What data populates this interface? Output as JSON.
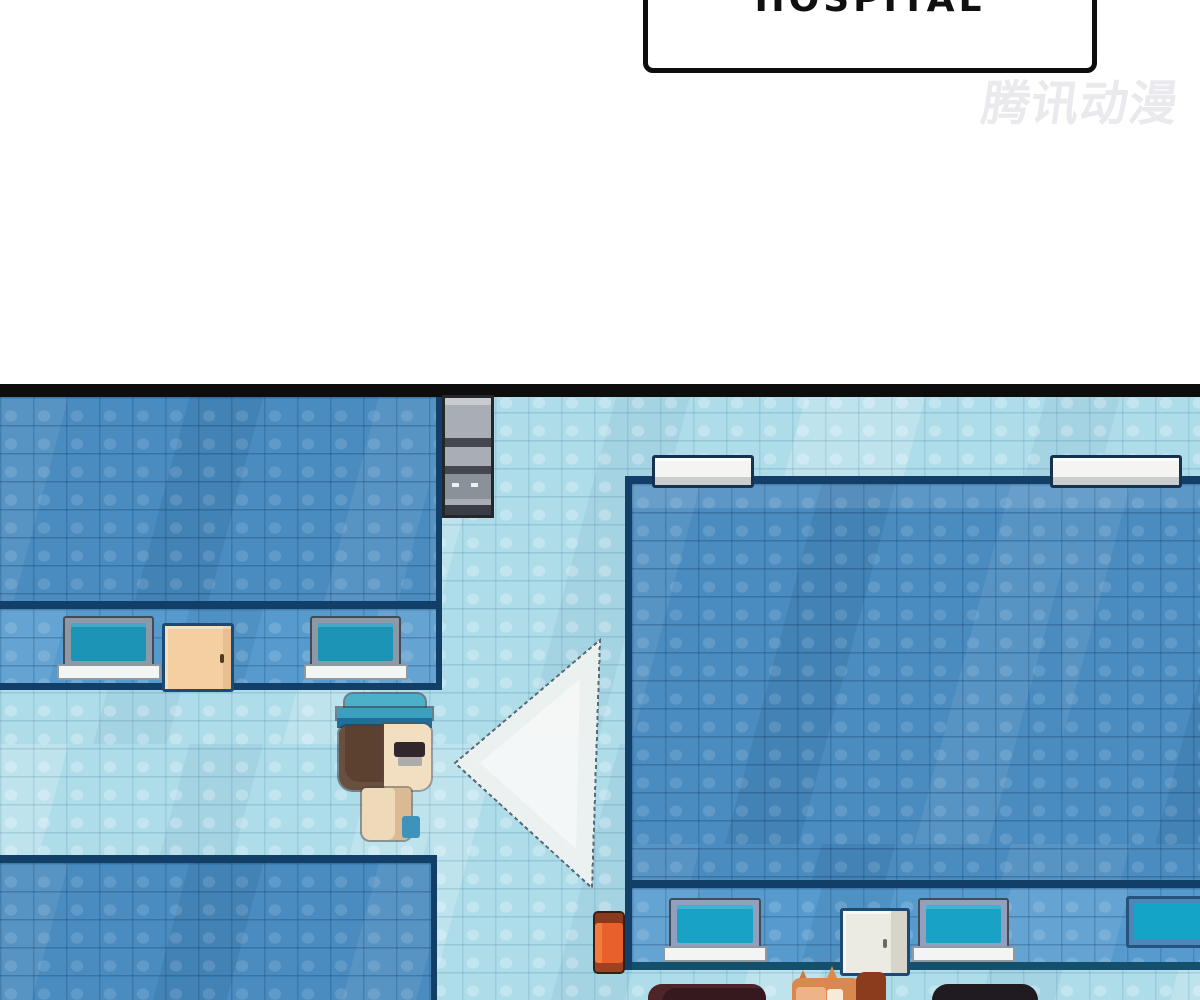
{
  "bubble": {
    "text": "HOSPITAL"
  },
  "watermark": {
    "text": "腾讯动漫"
  },
  "scene": {
    "style": "pixel-art top-down hospital map (comic panel)",
    "colors": {
      "corridor_tile": "#aedce9",
      "room_tile": "#4a8cc0",
      "wall_band_tile": "#579bce",
      "wall_outline": "#123f68",
      "panel_border": "#0d0d0d",
      "laptop_screen": "#1b94b6",
      "door_left": "#f3cfa2",
      "door_right": "#ecebe3",
      "extinguisher": "#e8602a",
      "cap": "#49aec6",
      "hair": "#5c4030",
      "skin": "#f2dfc2",
      "vision_cone": "#edf1ef"
    },
    "objects": [
      "top-left office room with two laptops and tan door",
      "gray supply cabinet",
      "nurse character with blue cap facing right",
      "white vision cone",
      "large right ward room with two white benches",
      "bottom desk row with two laptops, white door and wall monitor",
      "orange fire extinguisher",
      "three figures peeking over bottom edge"
    ]
  }
}
